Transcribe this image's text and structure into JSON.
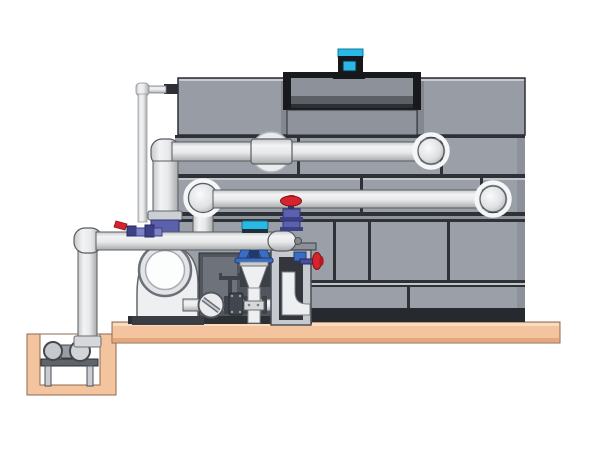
{
  "figure": {
    "alt": "Technical side-view illustration of a closed-circuit cooling tower on a concrete pad with pump skid, riser piping, control valves and a sump pit suction line"
  },
  "colors": {
    "background": "#ffffff",
    "tower_panel": "#9ba0a8",
    "tower_band": "#8f939b",
    "tower_box": "#989da5",
    "tower_base": "#26292e",
    "seam_dark": "#2e3136",
    "seam_light": "#c2c5ca",
    "fan_recess": "#17191d",
    "fan_cowl": "#8d9199",
    "platform_tan": "#f3c49e",
    "platform_edge": "#8c6a50",
    "valve_red": "#d6232e",
    "valve_purple": "#5c61ad",
    "valve_purple_dark": "#3c4186",
    "valve_purple_light": "#7d82c6",
    "valve_blue": "#3a6ec2",
    "actuator_cyan": "#28b9e6",
    "metal_dark": "#3f434a",
    "pipe_highlight": "#f4f5f6",
    "pipe_shadow": "#a8aaad"
  },
  "components": {
    "cooling_tower": "cooling tower casing with panel seams",
    "fan_motor": "cyan fan drive motor on top of fan cowl",
    "fan_cowl": "recessed fan discharge opening",
    "upper_pipe": "hot water return pipe into upper tower port",
    "middle_pipe": "spray water pipe with dome elbows",
    "lower_pipe": "pump discharge header with end cap",
    "overflow_pipe": "thin overflow / equalizer line",
    "riser": "vertical riser with flange and purple union",
    "pump": "centrifugal pump with circular suction housing",
    "control_valve": "cyan-actuated control valve on vertical drop leg",
    "globe_valve": "red handwheel globe valve on header end cap",
    "side_valve": "red handwheel valve on support stand",
    "ball_valve": "red lever ball valve on header",
    "strainer": "inline basket strainer with slotted cap",
    "gate_valve": "small gate valve on base piping",
    "stand": "steel support stand with internal drain elbow",
    "platform": "concrete equipment pad",
    "sump_pit": "below-grade sump pit",
    "sump_pump": "sump pump set on stand inside pit",
    "suction_line": "vertical suction pipe dropping into sump pit"
  }
}
